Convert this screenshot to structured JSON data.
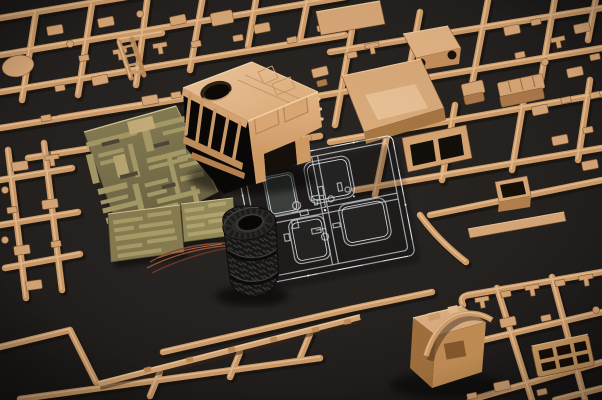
{
  "scene": {
    "type": "photograph",
    "subject": "Scale model kit contents laid out on a dark gray surface",
    "items": [
      {
        "name": "sprue-top-left",
        "description": "Tan plastic sprue grid with many small parts and an oval disc"
      },
      {
        "name": "sprue-top-right",
        "description": "Tan sprues with hood, floor panel, windshield frame, seats and plates"
      },
      {
        "name": "truck-cab",
        "description": "Tan truck cab body shell with round roof hatch hole and open window slots"
      },
      {
        "name": "photo-etch-sheet-large",
        "description": "Large olive-gold photo-etched brass fret with many etched strips"
      },
      {
        "name": "photo-etch-sheet-small-a",
        "description": "Small photo-etched brass fret"
      },
      {
        "name": "photo-etch-sheet-small-b",
        "description": "Second small photo-etched brass fret"
      },
      {
        "name": "copper-wires",
        "description": "Thin copper wire strands curving on the surface"
      },
      {
        "name": "tire-stack",
        "description": "Stack of three black rubber tires with chevron tread"
      },
      {
        "name": "clear-parts-sprue",
        "description": "Transparent sprue with four window panes and small clear parts"
      },
      {
        "name": "chassis-rails-sprue",
        "description": "Long tan chassis frame rails on runners across the bottom"
      },
      {
        "name": "sprue-bottom-right",
        "description": "Tan sprue with engine block, curved pipe, perforated tray and small parts"
      },
      {
        "name": "sprue-left-edge",
        "description": "Tan sprue strip along the left edge"
      }
    ]
  },
  "palette": {
    "bg": "#242120",
    "tan-base": "#d5a06c",
    "tan-hi": "#efcb9e",
    "tan-part": "#dcab7a",
    "tan-deep": "#b9powder",
    "tan-dk": "#8a5a34",
    "shadow": "#120d08",
    "pe-base": "#7d744e",
    "pe-light": "#a89c68",
    "pe-bright": "#d6c896",
    "tire-dark": "#171615",
    "tire-mid": "#2c2a28",
    "clear-line": "#c6cbcf",
    "clear-bright": "#f4f7f9",
    "wire-copper": "#9a5536",
    "void": "#0a0807"
  }
}
